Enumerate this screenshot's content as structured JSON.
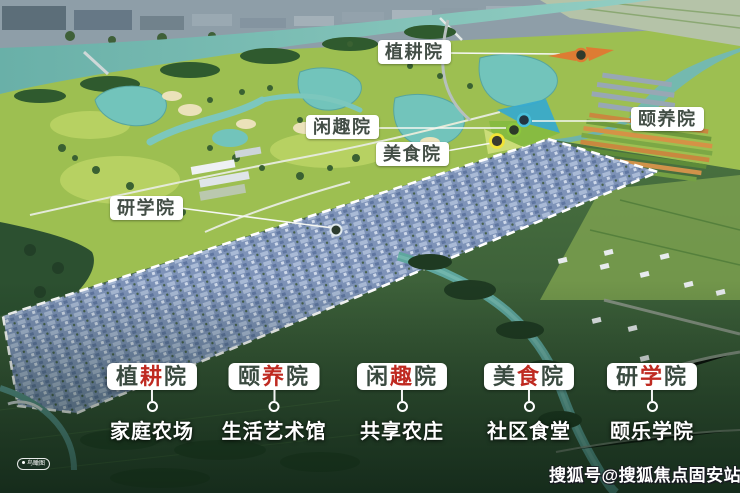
{
  "map": {
    "labels": [
      {
        "text": "植耕院"
      },
      {
        "text": "闲趣院"
      },
      {
        "text": "美食院"
      },
      {
        "text": "颐养院"
      },
      {
        "text": "研学院"
      }
    ],
    "markers": [
      {
        "name": "planting-zone-marker",
        "color": "#dd7c33"
      },
      {
        "name": "leisure-zone-marker",
        "color": "#8cc63e"
      },
      {
        "name": "food-zone-marker",
        "color": "#f2e336"
      },
      {
        "name": "wellness-zone-marker",
        "color": "#49c0dc"
      },
      {
        "name": "study-zone-marker",
        "color": "#dfe9ee"
      }
    ]
  },
  "legend": {
    "items": [
      {
        "chars": [
          "植",
          "耕",
          "院"
        ],
        "subtitle": "家庭农场"
      },
      {
        "chars": [
          "颐",
          "养",
          "院"
        ],
        "subtitle": "生活艺术馆"
      },
      {
        "chars": [
          "闲",
          "趣",
          "院"
        ],
        "subtitle": "共享农庄"
      },
      {
        "chars": [
          "美",
          "食",
          "院"
        ],
        "subtitle": "社区食堂"
      },
      {
        "chars": [
          "研",
          "学",
          "院"
        ],
        "subtitle": "颐乐学院"
      }
    ]
  },
  "badge": {
    "text": "鸟瞰图"
  },
  "watermark": {
    "text": "搜狐号@搜狐焦点固安站"
  },
  "colors": {
    "accent_red": "#bf2a21",
    "label_green": "#3a4a40",
    "village_blue": "#7e93b8",
    "river_teal": "#6fb7ae"
  }
}
